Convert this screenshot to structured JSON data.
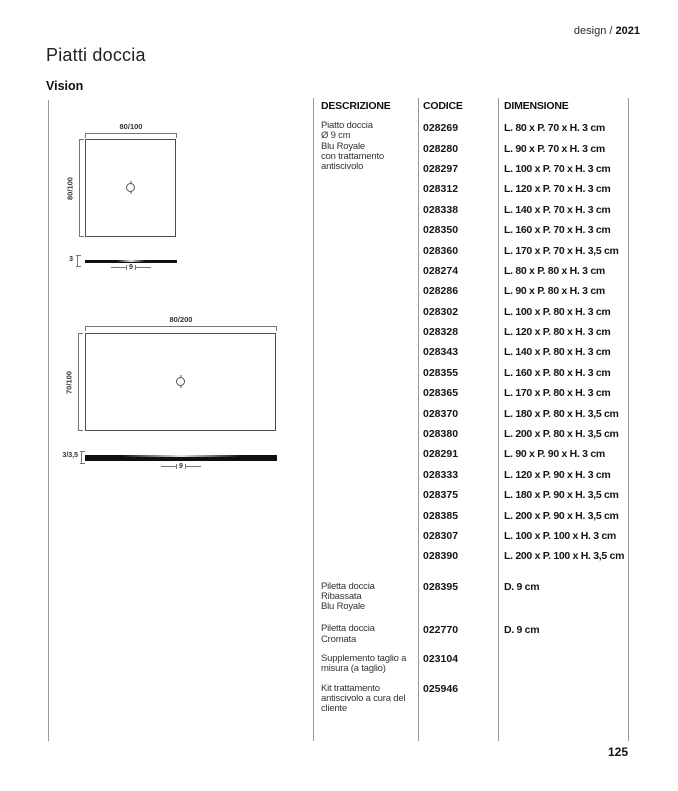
{
  "header": {
    "edition_prefix": "design / ",
    "edition_year": "2021",
    "title": "Piatti doccia",
    "subtitle": "Vision"
  },
  "footer": {
    "page_number": "125"
  },
  "table": {
    "headers": [
      "DESCRIZIONE",
      "CODICE",
      "DIMENSIONE"
    ],
    "groups": [
      {
        "description": [
          "Piatto doccia",
          "Ø 9 cm",
          "Blu Royale",
          "con trattamento",
          "antiscivolo"
        ],
        "rows": [
          {
            "code": "028269",
            "dimension": "L. 80 x P. 70 x H. 3 cm"
          },
          {
            "code": "028280",
            "dimension": "L. 90 x P. 70 x H. 3 cm"
          },
          {
            "code": "028297",
            "dimension": "L. 100 x P. 70 x H. 3 cm"
          },
          {
            "code": "028312",
            "dimension": "L. 120 x P. 70 x H. 3 cm"
          },
          {
            "code": "028338",
            "dimension": "L. 140 x P. 70 x H. 3 cm"
          },
          {
            "code": "028350",
            "dimension": "L. 160 x P. 70 x H. 3 cm"
          },
          {
            "code": "028360",
            "dimension": "L. 170 x P. 70 x H. 3,5 cm"
          },
          {
            "code": "028274",
            "dimension": "L. 80 x P. 80 x H. 3 cm"
          },
          {
            "code": "028286",
            "dimension": "L. 90 x P. 80 x H. 3 cm"
          },
          {
            "code": "028302",
            "dimension": "L. 100 x P. 80 x H. 3 cm"
          },
          {
            "code": "028328",
            "dimension": "L. 120 x P. 80 x H. 3 cm"
          },
          {
            "code": "028343",
            "dimension": "L. 140 x P. 80 x H. 3 cm"
          },
          {
            "code": "028355",
            "dimension": "L. 160 x P. 80 x H. 3 cm"
          },
          {
            "code": "028365",
            "dimension": "L. 170 x P. 80 x H. 3 cm"
          },
          {
            "code": "028370",
            "dimension": "L. 180 x P. 80 x H. 3,5 cm"
          },
          {
            "code": "028380",
            "dimension": "L. 200 x P. 80 x H. 3,5 cm"
          },
          {
            "code": "028291",
            "dimension": "L. 90 x P. 90 x H. 3 cm"
          },
          {
            "code": "028333",
            "dimension": "L. 120 x P. 90 x H. 3 cm"
          },
          {
            "code": "028375",
            "dimension": "L. 180 x P. 90 x H. 3,5 cm"
          },
          {
            "code": "028385",
            "dimension": "L. 200 x P. 90 x H. 3,5 cm"
          },
          {
            "code": "028307",
            "dimension": "L. 100 x P. 100 x H. 3 cm"
          },
          {
            "code": "028390",
            "dimension": "L. 200 x P. 100 x H. 3,5 cm"
          }
        ]
      },
      {
        "description": [
          "Piletta doccia",
          "Ribassata",
          "Blu Royale"
        ],
        "rows": [
          {
            "code": "028395",
            "dimension": "D. 9 cm"
          }
        ]
      },
      {
        "description": [
          "Piletta doccia",
          "Cromata"
        ],
        "rows": [
          {
            "code": "022770",
            "dimension": "D. 9 cm"
          }
        ]
      },
      {
        "description": [
          "Supplemento taglio a",
          "misura (a taglio)"
        ],
        "rows": [
          {
            "code": "023104",
            "dimension": ""
          }
        ]
      },
      {
        "description": [
          "Kit trattamento",
          "antiscivolo a cura del",
          "cliente"
        ],
        "rows": [
          {
            "code": "025946",
            "dimension": ""
          }
        ]
      }
    ]
  },
  "diagrams": [
    {
      "plan_width_label": "80/100",
      "plan_depth_label": "80/100",
      "profile_height_label": "3",
      "profile_drain_label": "9"
    },
    {
      "plan_width_label": "80/200",
      "plan_depth_label": "70/100",
      "profile_height_label": "3/3,5",
      "profile_drain_label": "9"
    }
  ]
}
